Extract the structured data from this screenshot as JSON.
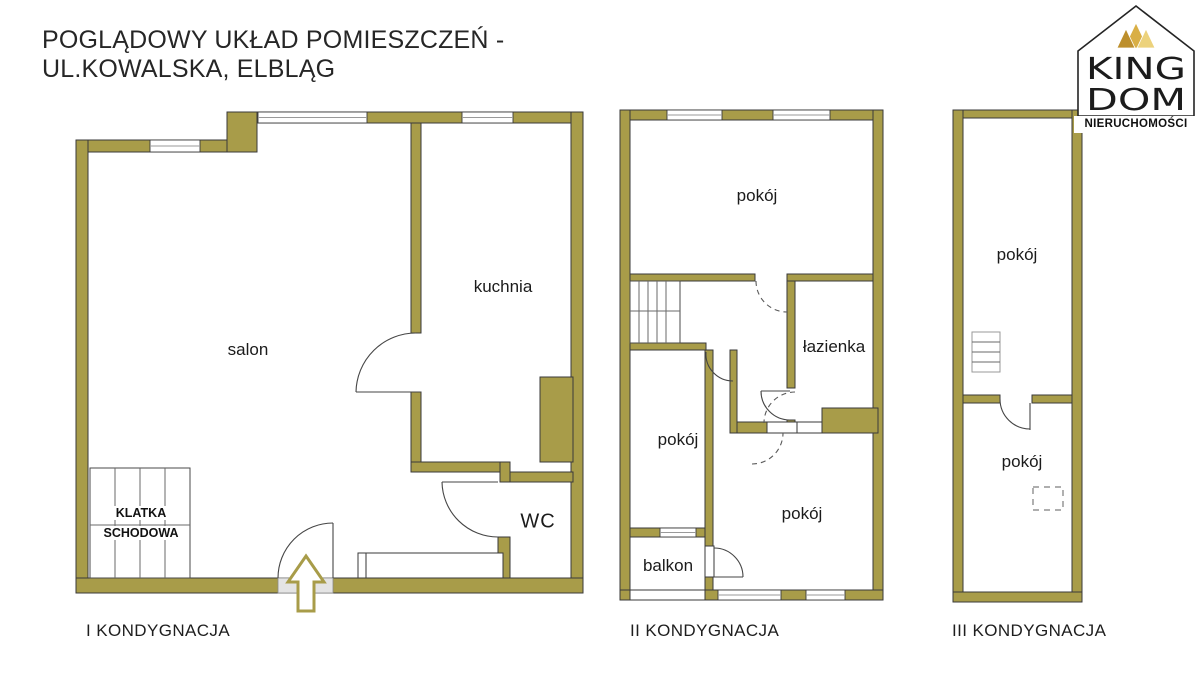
{
  "title": {
    "line1": "POGLĄDOWY UKŁAD POMIESZCZEŃ -",
    "line2": "UL.KOWALSKA, ELBLĄG"
  },
  "logo": {
    "king": "KING",
    "dom": "DOM",
    "tagline": "NIERUCHOMOŚCI"
  },
  "colors": {
    "wall": "#a89c49",
    "wall_stroke": "#3a3a3a",
    "line": "#454545",
    "entrance_fill": "#e4e4e4",
    "crown_dark": "#bd8f2c",
    "crown_mid": "#d9af45",
    "crown_light": "#ecd27c",
    "text": "#1f1f1f"
  },
  "floors": [
    {
      "caption": "I KONDYGNACJA",
      "stairs": {
        "line1": "KLATKA",
        "line2": "SCHODOWA"
      },
      "rooms": [
        {
          "label": "salon",
          "x": 248,
          "y": 350
        },
        {
          "label": "kuchnia",
          "x": 503,
          "y": 287
        },
        {
          "label": "WC",
          "x": 538,
          "y": 522,
          "size": "lg"
        }
      ]
    },
    {
      "caption": "II KONDYGNACJA",
      "rooms": [
        {
          "label": "pokój",
          "x": 757,
          "y": 196
        },
        {
          "label": "pokój",
          "x": 678,
          "y": 440
        },
        {
          "label": "pokój",
          "x": 802,
          "y": 514
        },
        {
          "label": "łazienka",
          "x": 834,
          "y": 347
        },
        {
          "label": "balkon",
          "x": 668,
          "y": 566
        }
      ]
    },
    {
      "caption": "III KONDYGNACJA",
      "rooms": [
        {
          "label": "pokój",
          "x": 1017,
          "y": 255
        },
        {
          "label": "pokój",
          "x": 1022,
          "y": 462
        }
      ]
    }
  ]
}
